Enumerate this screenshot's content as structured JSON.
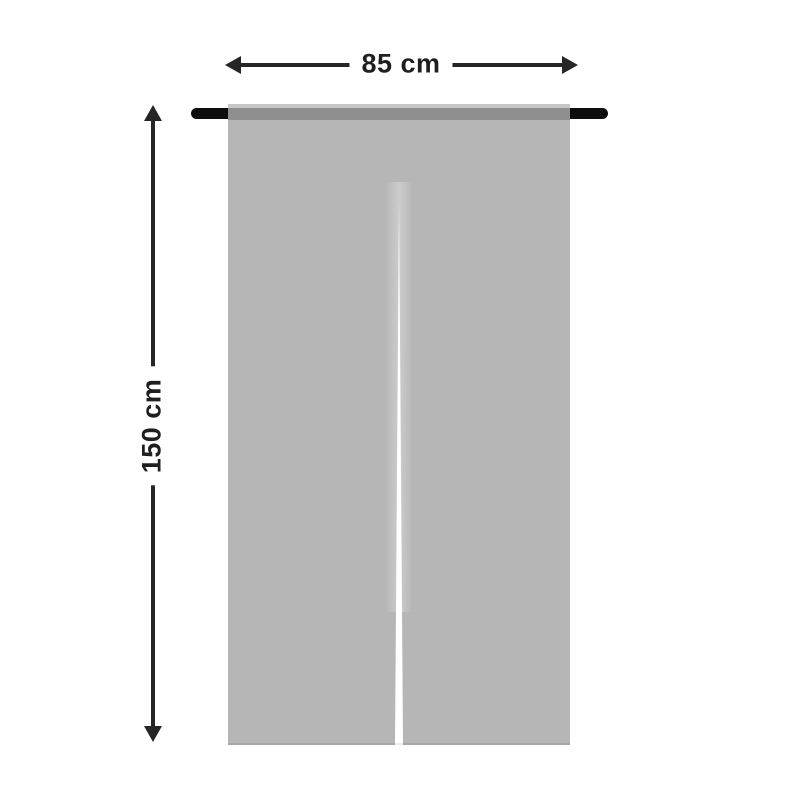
{
  "background": "#ffffff",
  "diagram": {
    "width_dimension": {
      "label": "85 cm",
      "left_arrow_icon": "arrow-left",
      "right_arrow_icon": "arrow-right"
    },
    "height_dimension": {
      "label": "150 cm",
      "up_arrow_icon": "arrow-up",
      "down_arrow_icon": "arrow-down"
    },
    "colors": {
      "annotation_line": "#262626",
      "label_text": "#1f1f1f",
      "rod": "#0d0d0d",
      "curtain_body": "#b6b6b6",
      "curtain_rod_pocket": "#8f8f8f",
      "curtain_top_hem": "#c6c6c6",
      "center_split": "#ffffff"
    }
  }
}
